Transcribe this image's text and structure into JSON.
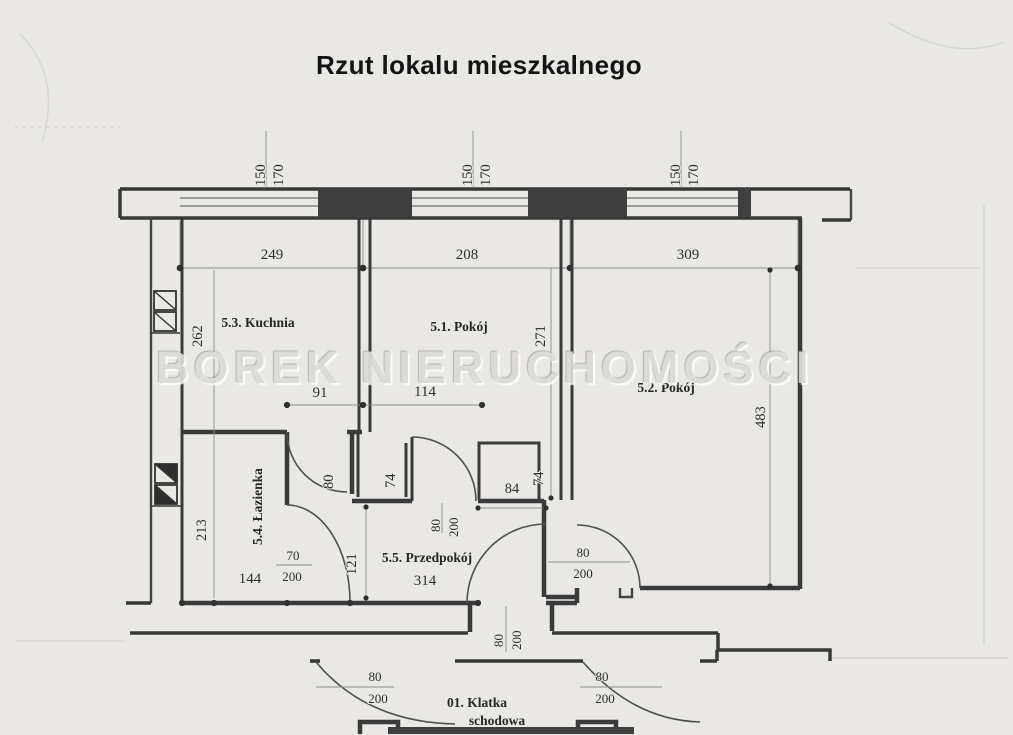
{
  "title": "Rzut lokalu mieszkalnego",
  "watermark": "BOREK NIERUCHOMOŚCI",
  "rooms": {
    "kitchen": "5.3. Kuchnia",
    "room1": "5.1. Pokój",
    "room2": "5.2. Pokój",
    "bathroom": "5.4. Łazienka",
    "hall": "5.5. Przedpokój",
    "staircase_line1": "01. Klatka",
    "staircase_line2": "schodowa"
  },
  "dims": {
    "win1_w": "150",
    "win1_h": "170",
    "win2_w": "150",
    "win2_h": "170",
    "win3_w": "150",
    "win3_h": "170",
    "span_kitchen": "249",
    "span_room1": "208",
    "span_room2": "309",
    "kitchen_depth": "262",
    "room1_depth": "271",
    "room2_depth": "483",
    "alcove_width": "91",
    "door_span": "114",
    "bath_depth": "213",
    "bath_width": "144",
    "bath_door_w": "70",
    "bath_door_h": "200",
    "hall_depth": "121",
    "hall_length": "314",
    "kitchen_door_w": "80",
    "pier_left": "74",
    "pier_right_a": "84",
    "pier_right_b": "74",
    "room1_door_w": "80",
    "room1_door_h": "200",
    "room2_door_w": "80",
    "room2_door_h": "200",
    "entry_door_w": "80",
    "entry_door_h": "200",
    "stair_left_w": "80",
    "stair_left_h": "200",
    "stair_right_w": "80",
    "stair_right_h": "200"
  }
}
